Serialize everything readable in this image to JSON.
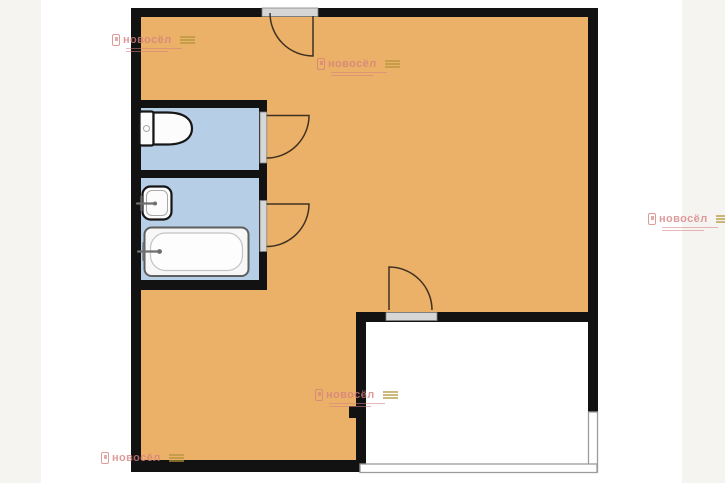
{
  "watermark": {
    "brand": "новосёл"
  },
  "colors": {
    "page_band": "#f5f4f0",
    "page": "#ffffff",
    "wall": "#121212",
    "floor": "#ecb168",
    "wet_room": "#b7cee7",
    "annex_floor": "#ffffff",
    "annex_wall": "#9c9c9c",
    "threshold_fill": "#d6d6d6",
    "threshold_edge": "#808080",
    "door_swing": "#3f3122",
    "fixture_fill": "#fcfcfc",
    "fixture_stroke": "#161616",
    "tub_stroke": "#5f5f5f",
    "tub_rim": "#c4c4c4",
    "faucet": "#6f6f6f",
    "watermark_pink": "#d4807f",
    "watermark_gold": "#b3953a"
  },
  "plan": {
    "rooms": [
      {
        "name": "main-room"
      },
      {
        "name": "toilet-room"
      },
      {
        "name": "bathroom"
      },
      {
        "name": "annex-room"
      }
    ],
    "fixtures": [
      {
        "name": "toilet"
      },
      {
        "name": "sink"
      },
      {
        "name": "bathtub"
      }
    ],
    "doors": [
      {
        "name": "entrance-door"
      },
      {
        "name": "toilet-door"
      },
      {
        "name": "bathroom-door"
      },
      {
        "name": "annex-door"
      }
    ]
  }
}
